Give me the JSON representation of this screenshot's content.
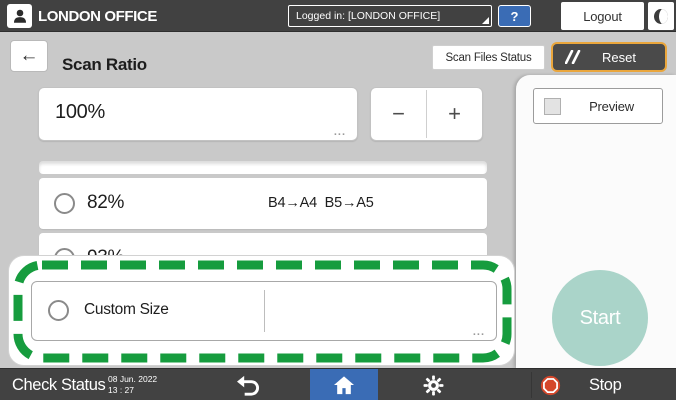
{
  "colors": {
    "bar_dark": "#414141",
    "content_bg": "#c9c9c9",
    "accent_blue": "#3a6cb5",
    "reset_border_orange": "#eaa63c",
    "start_teal": "#aad4c9",
    "highlight_green": "#169c3e",
    "stop_red": "#d5472b"
  },
  "top_bar": {
    "user_name": "LONDON OFFICE",
    "login_status": "Logged in: [LONDON OFFICE]",
    "help_label": "?",
    "logout_label": "Logout"
  },
  "title_bar": {
    "back_glyph": "←",
    "title": "Scan Ratio",
    "scan_files_status_label": "Scan Files Status",
    "reset_label": "Reset"
  },
  "ratio_editor": {
    "value": "100%",
    "ellipsis": "...",
    "minus_glyph": "−",
    "plus_glyph": "+"
  },
  "ratio_list": {
    "option_82": {
      "label": "82%",
      "detail": "B4→A4  B5→A5"
    },
    "option_93": {
      "label": "93%"
    },
    "custom": {
      "label": "Custom Size",
      "ellipsis": "..."
    }
  },
  "action_panel": {
    "preview_label": "Preview",
    "start_label": "Start"
  },
  "bottom_bar": {
    "check_status_label": "Check Status",
    "date": "08 Jun. 2022",
    "time": "13 : 27",
    "stop_label": "Stop"
  },
  "icons": {
    "user": "person-silhouette",
    "login_dropdown": "corner-triangle",
    "sleep": "crescent-moon",
    "reset": "double-slash",
    "radio": "radio-circle",
    "preview_checkbox": "checkbox-square",
    "undo": "curved-back-arrow",
    "home": "house",
    "settings": "gear",
    "stop": "stop-octagon"
  }
}
